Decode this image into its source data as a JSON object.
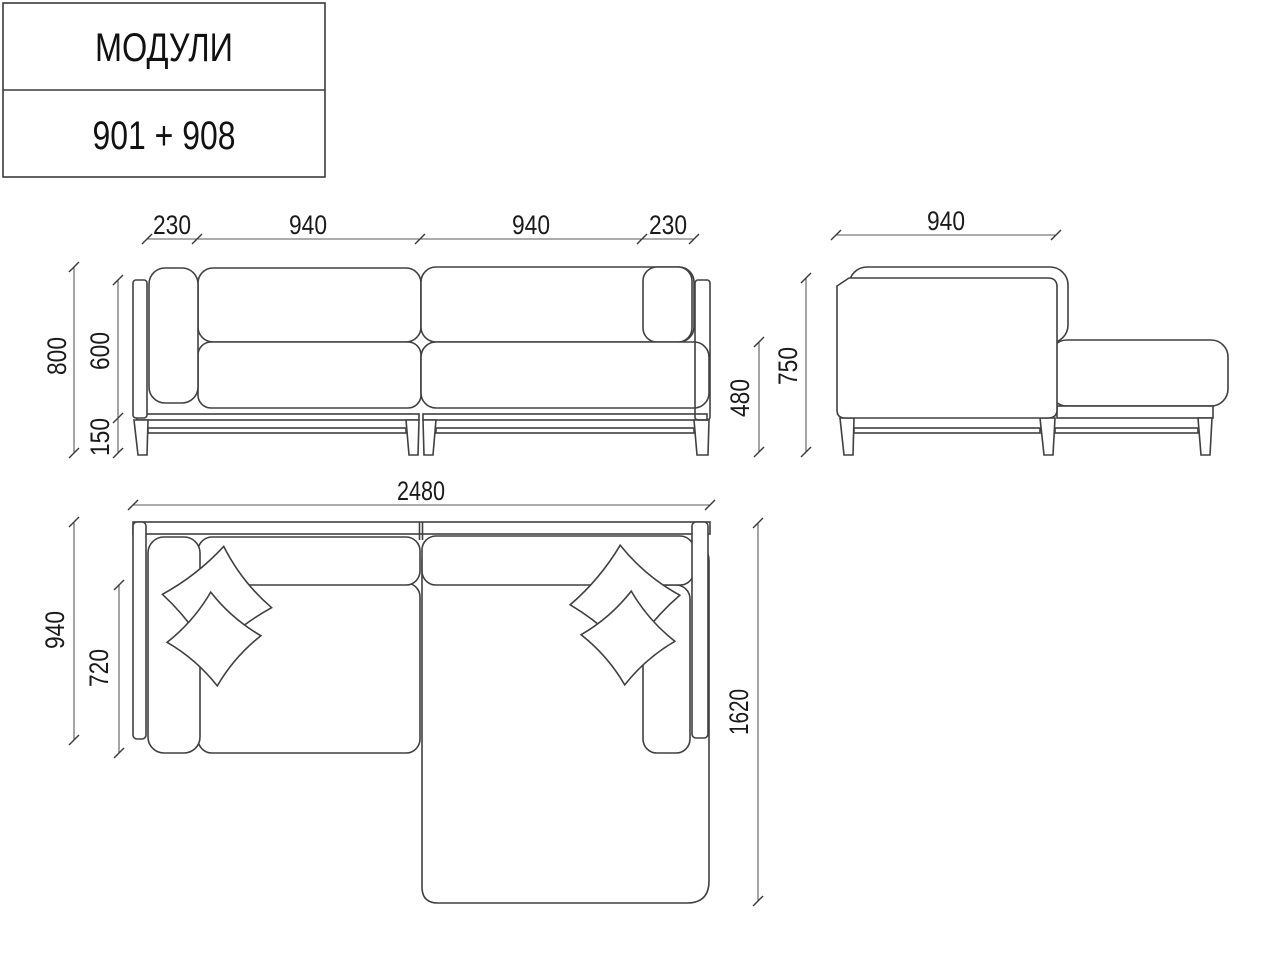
{
  "title_block": {
    "model_label": "МОДУЛИ",
    "model_code": "901 + 908"
  },
  "front_view": {
    "dim_arm_left": "230",
    "dim_module_left": "940",
    "dim_module_right": "940",
    "dim_arm_right": "230",
    "dim_total_height": "800",
    "dim_back_height": "600",
    "dim_leg_height": "150",
    "dim_seat_height": "480"
  },
  "side_view": {
    "dim_depth": "940",
    "dim_height": "750"
  },
  "plan_view": {
    "dim_total_width": "2480",
    "dim_total_depth": "940",
    "dim_seat_depth": "720",
    "dim_chaise_length": "1620"
  },
  "colors": {
    "line": "#404040",
    "dimension": "#5a5a5a",
    "text": "#1a1a1a",
    "background": "#ffffff"
  }
}
